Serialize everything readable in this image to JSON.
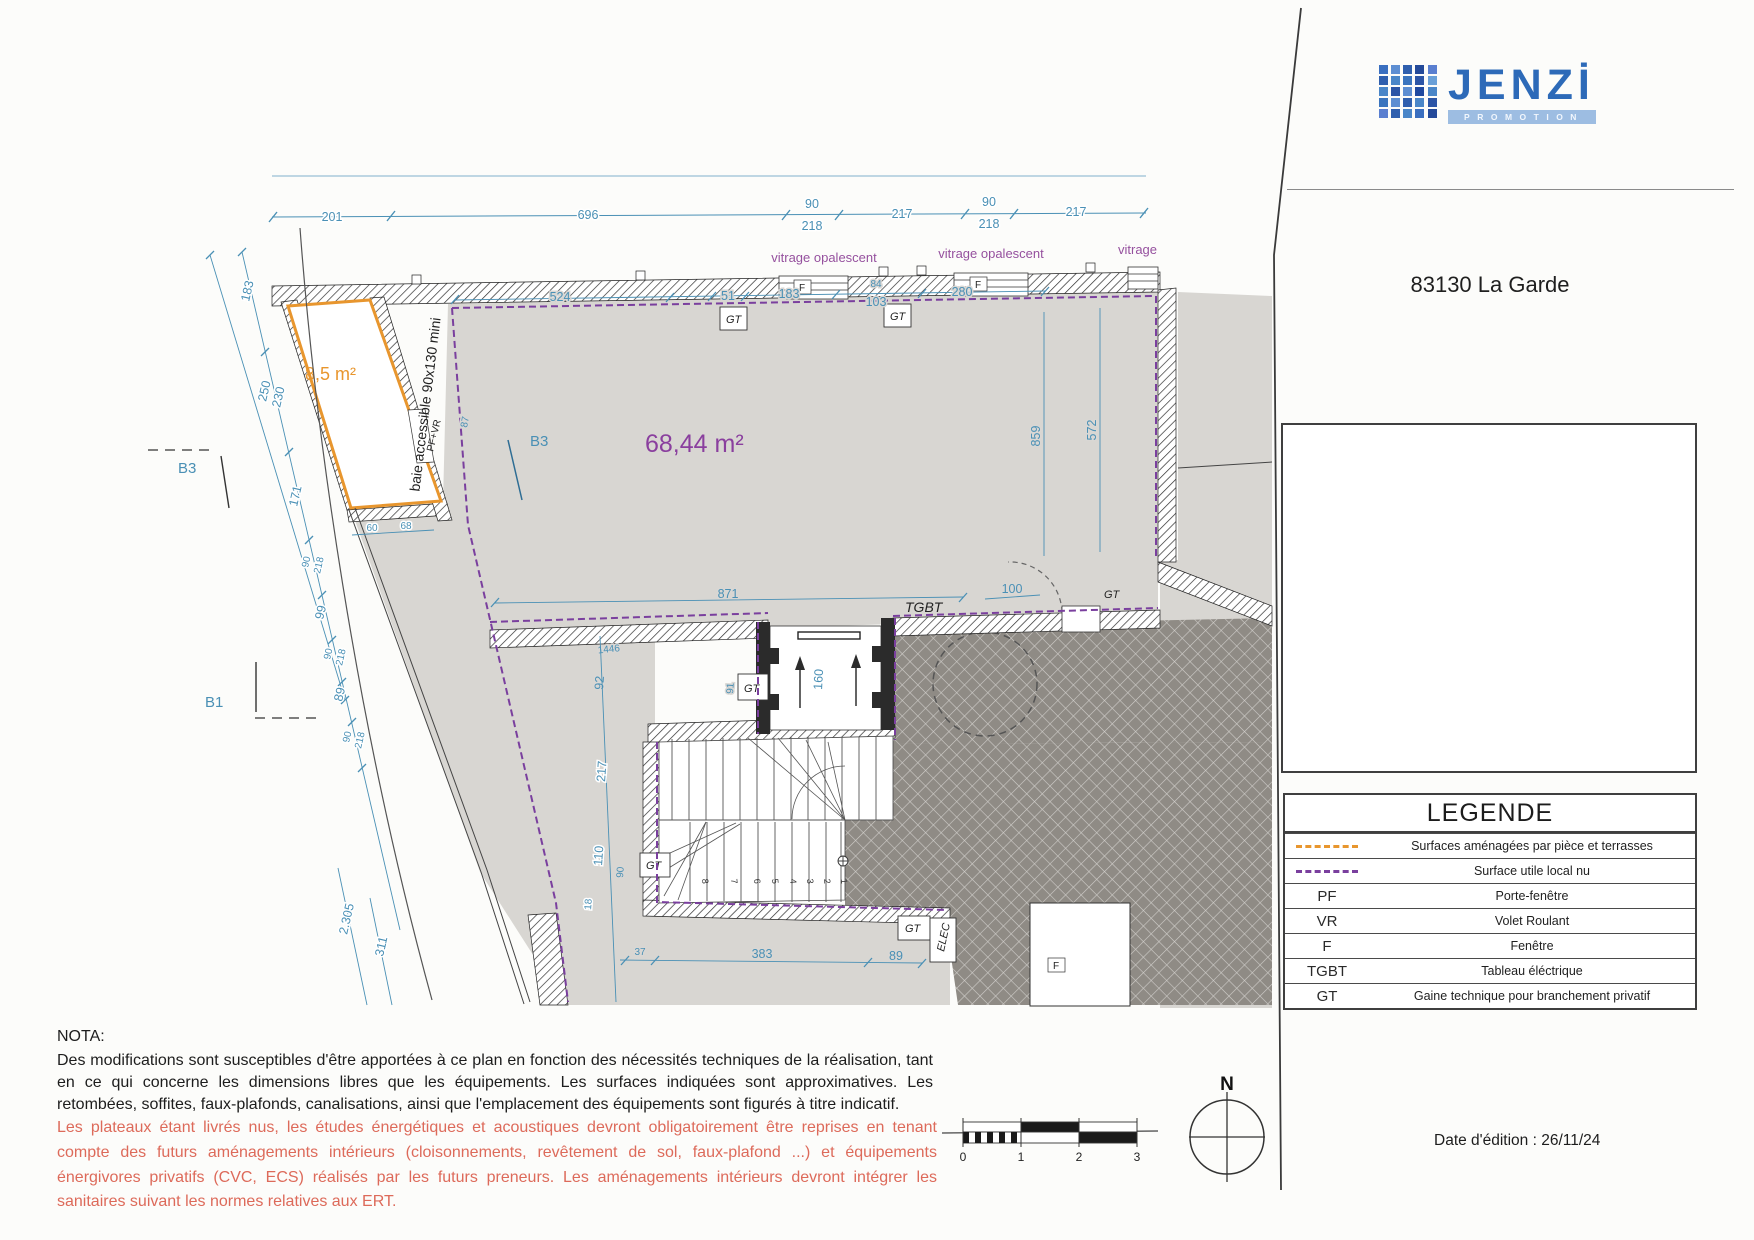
{
  "logo": {
    "name": "JENZİ",
    "sub": "PROMOTION"
  },
  "address": "83130 La Garde",
  "reperage": {
    "title": "Repérage",
    "units": [
      "1.2",
      "1.5",
      "1.3",
      "1.1",
      "1.4"
    ]
  },
  "legende": {
    "title": "LEGENDE",
    "rows": [
      {
        "key": "",
        "label": "Surfaces aménagées par pièce et terrasses"
      },
      {
        "key": "",
        "label": "Surface utile local nu"
      },
      {
        "key": "PF",
        "label": "Porte-fenêtre"
      },
      {
        "key": "VR",
        "label": "Volet Roulant"
      },
      {
        "key": "F",
        "label": "Fenêtre"
      },
      {
        "key": "TGBT",
        "label": "Tableau éléctrique"
      },
      {
        "key": "GT",
        "label": "Gaine technique pour branchement privatif"
      }
    ]
  },
  "edition": "Date d'édition : 26/11/24",
  "nota": {
    "title": "NOTA:",
    "body": "Des modifications sont susceptibles d'être apportées à ce plan en fonction des nécessités techniques de la réalisation, tant en ce qui concerne les dimensions libres que les équipements. Les surfaces indiquées sont approximatives. Les retombées, soffites, faux-plafonds, canalisations, ainsi que l'emplacement des équipements sont figurés à titre indicatif."
  },
  "warning": "Les plateaux étant livrés nus, les études énergétiques et acoustiques devront obligatoirement être reprises en tenant compte des futurs aménagements intérieurs (cloisonnements, revêtement de sol, faux-plafond ...) et équipements énergivores privatifs (CVC, ECS) réalisés par les futurs preneurs. Les aménagements intérieurs devront intégrer les sanitaires suivant les normes relatives aux ERT.",
  "compass": "N",
  "scalebar": {
    "ticks": [
      "0",
      "1",
      "2",
      "3"
    ]
  },
  "plan": {
    "areas": {
      "main": "68,44 m²",
      "terrace": "8,5 m²"
    },
    "notes": {
      "baie": "baie accessible 90x130 mini",
      "pfvr": "PF+VR"
    },
    "glazing": "vitrage opalescent",
    "glazing_short": "vitrage",
    "labels": {
      "tgbt": "TGBT",
      "gt": "GT",
      "elec": "ELEC",
      "f": "F",
      "b3": "B3",
      "b1": "B1"
    },
    "stairs": [
      "1",
      "2",
      "3",
      "4",
      "5",
      "6",
      "7",
      "8"
    ],
    "dims": {
      "d201": "201",
      "d696": "696",
      "d90": "90",
      "d218": "218",
      "d217": "217",
      "d524": "524",
      "d51": "51",
      "d183": "183",
      "d84": "84",
      "d103": "103",
      "d280": "280",
      "d859": "859",
      "d572": "572",
      "d250": "250",
      "d230": "230",
      "d171": "171",
      "d99": "99",
      "d89": "89",
      "d60": "60",
      "d68": "68",
      "d87": "87",
      "d871": "871",
      "d100": "100",
      "d160": "160",
      "d92": "92",
      "d91": "91",
      "d1446": "1446",
      "d110": "110",
      "d18": "18",
      "d37": "37",
      "d383": "383",
      "d2305": "2.305",
      "d311": "311"
    }
  }
}
